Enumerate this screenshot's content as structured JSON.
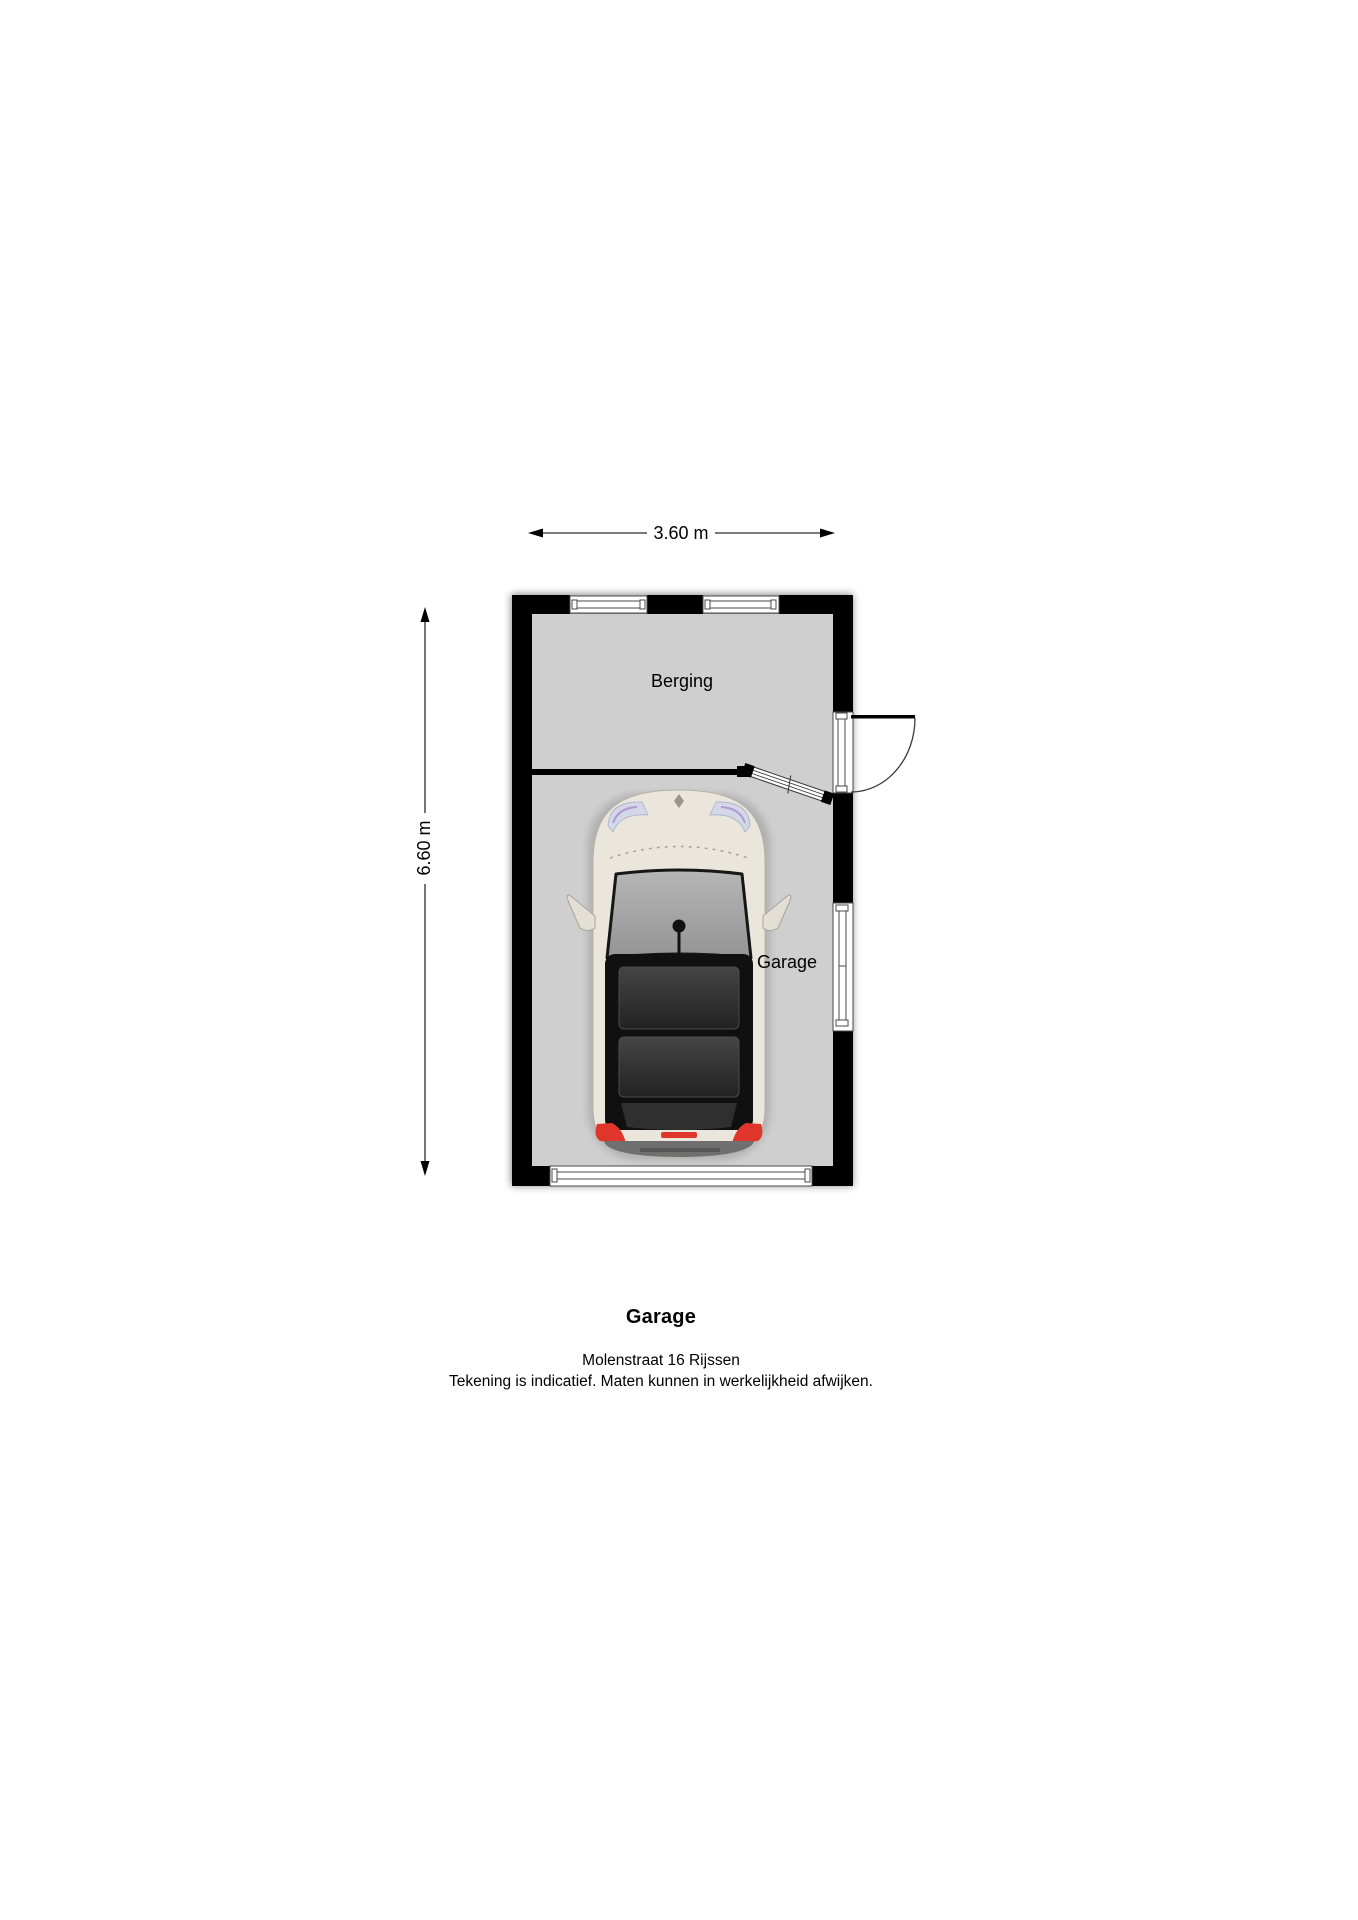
{
  "page": {
    "title": "Garage",
    "address_line": "Molenstraat 16 Rijssen",
    "disclaimer_line": "Tekening is indicatief. Maten kunnen in werkelijkheid afwijken."
  },
  "floor_plan": {
    "dimensions": {
      "width": "3.60 m",
      "height": "6.60 m"
    },
    "rooms": [
      {
        "label": "Berging"
      },
      {
        "label": "Garage"
      }
    ],
    "colors": {
      "wall": "#000000",
      "floor": "#cfcfcf",
      "background": "#ffffff",
      "frame_line": "#4a4a4a",
      "car_body": "#ebe6dc",
      "taillight_red": "#e0352b"
    }
  }
}
